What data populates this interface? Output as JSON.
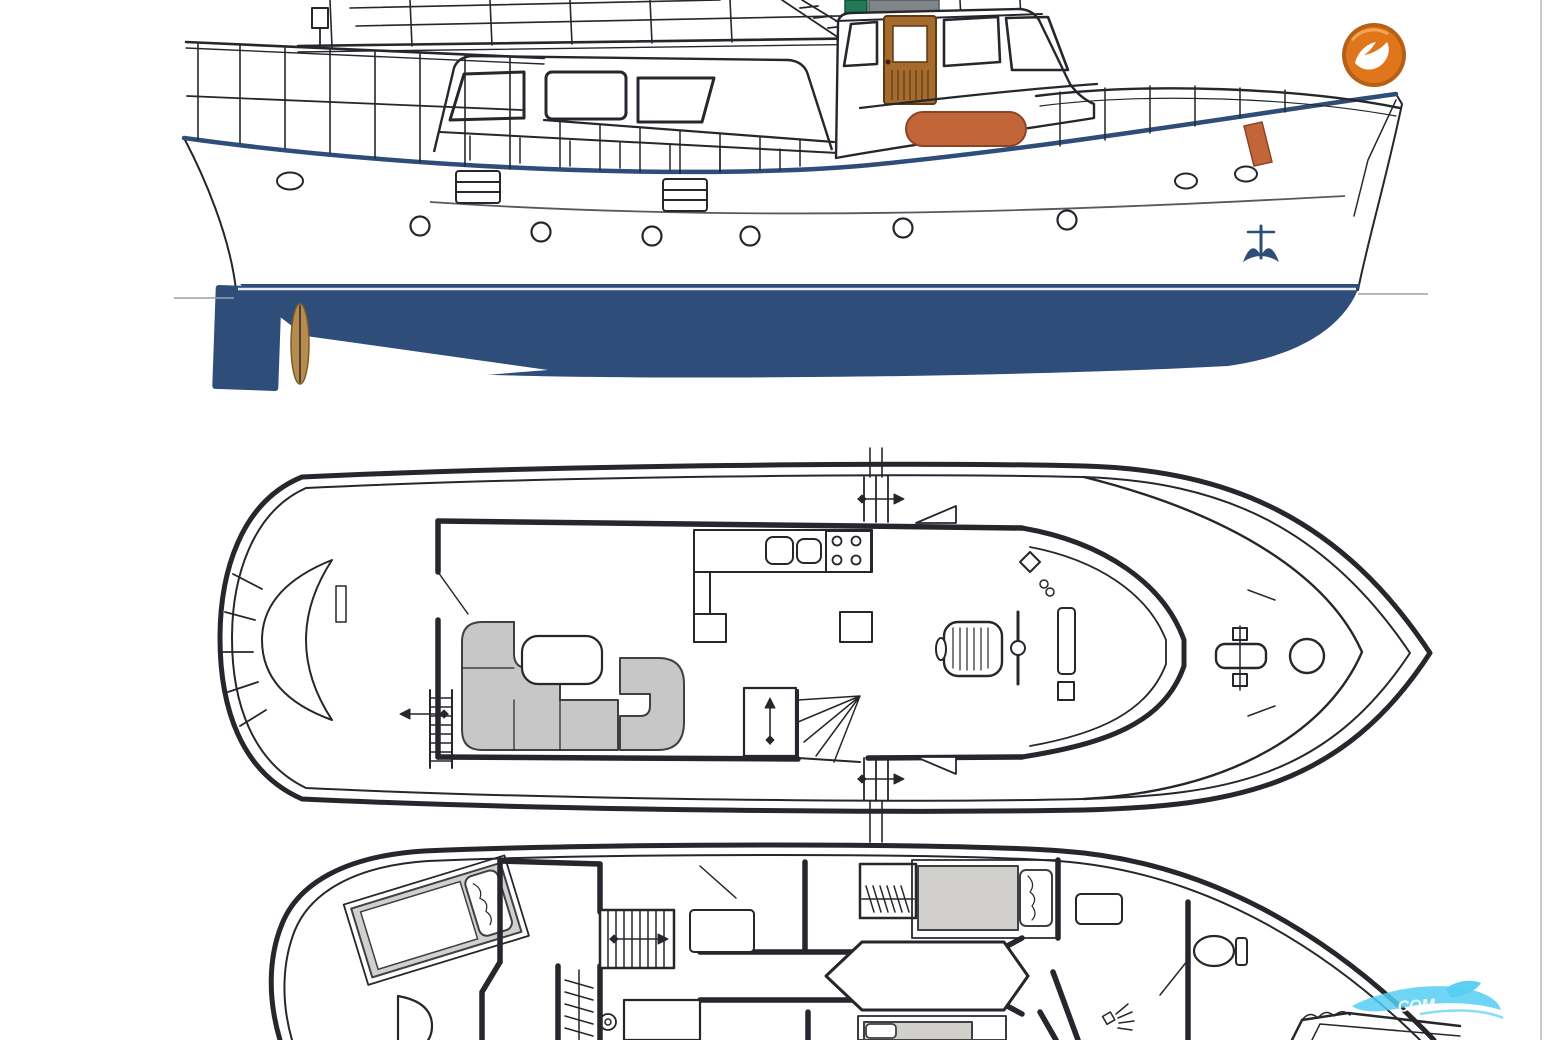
{
  "branding": {
    "logo": {
      "glyph": "seagull",
      "shape": "circle-badge"
    },
    "watermark": {
      "visible_text": "COM",
      "style": "wave-swoosh"
    }
  },
  "colors": {
    "ink": "#25272c",
    "hull_navy": "#2e4d79",
    "boot_light": "#e8edf2",
    "accent_orange": "#c2663a",
    "accent_orange_edge": "#8a4526",
    "wood_brown": "#a56a2e",
    "wood_dark": "#5d3a12",
    "propeller_bronze": "#b78c4e",
    "equipment_green": "#1f7a55",
    "equipment_gray": "#808589",
    "upholstery_gray": "#c7c7c7",
    "berth_gray": "#d2d0cd",
    "watermark_cyan": "#55cff2",
    "logo_orange": "#e0761c",
    "logo_ring": "#b35708",
    "logo_glyph": "#ffffff",
    "page_edge_gray": "#c9c9c9",
    "rub_line": "#565a60",
    "waterline_gray": "#9aa1a8"
  },
  "figures": {
    "side_profile": {
      "name": "motor-yacht-side-profile",
      "features": [
        "flybridge",
        "wheelhouse",
        "wood-door",
        "saloon-windows",
        "life-raft",
        "anchor",
        "rudder",
        "propeller",
        "navy-antifouling"
      ],
      "porthole_count": 6
    },
    "main_deck_plan": {
      "name": "main-deck-floor-plan",
      "features": [
        "stern-bench",
        "boarding-ladder",
        "u-sofa-left",
        "u-sofa-right",
        "saloon-table",
        "galley-sinks",
        "galley-stove",
        "companionway-stairs",
        "helm-seat",
        "steering-wheel",
        "instrument-console",
        "anchor-windlass",
        "deck-hatch"
      ]
    },
    "lower_deck_plan": {
      "name": "lower-deck-floor-plan",
      "features": [
        "aft-cabin-berth",
        "stairs",
        "hanging-lockers",
        "guest-berth",
        "vanity-desk",
        "corridor",
        "toilet",
        "shower",
        "bow-berth"
      ]
    }
  }
}
